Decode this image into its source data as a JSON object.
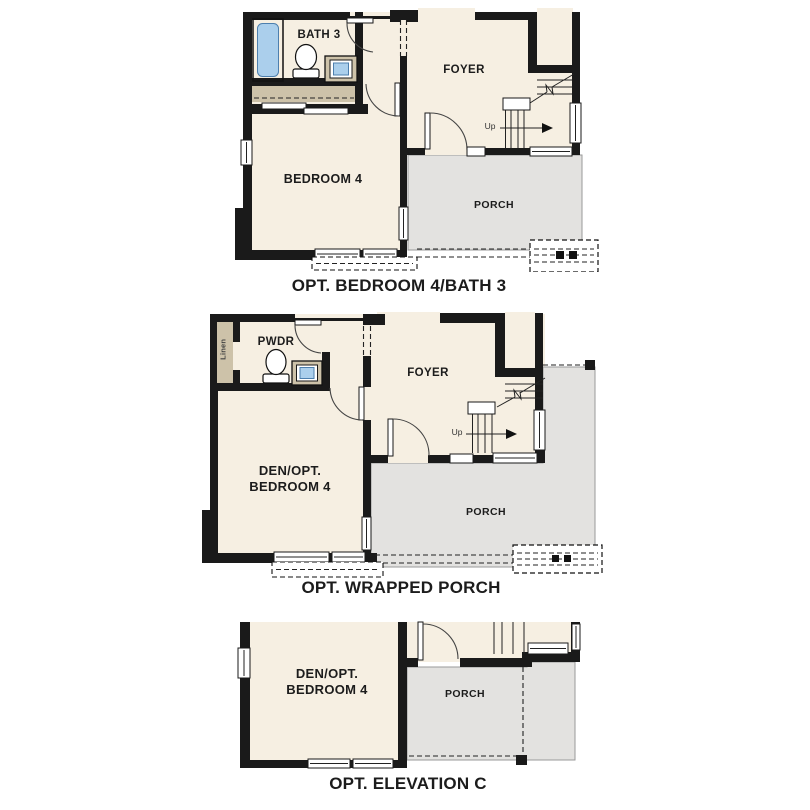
{
  "colors": {
    "background": "#ffffff",
    "floor": "#f6efe2",
    "porch": "#e3e2e0",
    "wall": "#1a1a1a",
    "casework": "#cdc2a9",
    "fixture": "#abcfec",
    "text": "#1c1c1c"
  },
  "plans": [
    {
      "caption": "OPT. BEDROOM 4/BATH 3",
      "rooms": {
        "bath": "BATH 3",
        "foyer": "FOYER",
        "bedroom": "BEDROOM 4",
        "porch": "PORCH"
      },
      "stairs_label": "Up"
    },
    {
      "caption": "OPT. WRAPPED PORCH",
      "rooms": {
        "linen": "Linen",
        "powder": "PWDR",
        "foyer": "FOYER",
        "den_line1": "DEN/OPT.",
        "den_line2": "BEDROOM 4",
        "porch": "PORCH"
      },
      "stairs_label": "Up"
    },
    {
      "caption": "OPT. ELEVATION C",
      "rooms": {
        "den_line1": "DEN/OPT.",
        "den_line2": "BEDROOM 4",
        "porch": "PORCH"
      }
    }
  ]
}
